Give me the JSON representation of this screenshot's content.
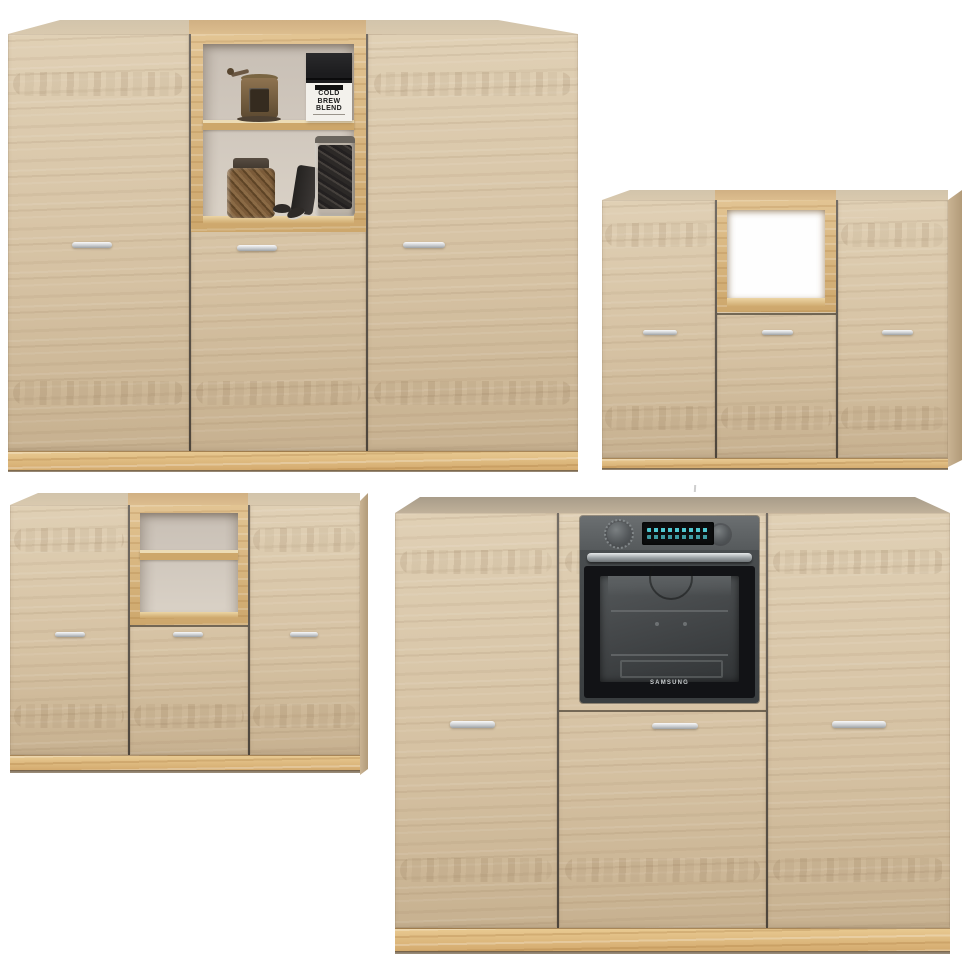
{
  "page": {
    "background": "#ffffff"
  },
  "theme": {
    "colors": {
      "wood_light": "#e0d0b5",
      "wood_base": "#d5c1a2",
      "wood_dark": "#c7b190",
      "plinth_light": "#e8c991",
      "plinth_base": "#d3a96c",
      "gold_light": "#e2c493",
      "gold_base": "#cda76c",
      "cap_light": "#d2c4ab",
      "cap_base": "#d9c9ae",
      "cap_dark_light": "#a89c89",
      "cap_dark_base": "#c0b19a",
      "gap": "#3e352a",
      "niche_back_top": "#c8bfb5",
      "niche_back_bottom": "#dad2c7",
      "handle_light": "#fafafa",
      "handle_mid": "#c7cacd",
      "handle_dark": "#9ea2a5",
      "oven_panel_light": "#6b6f71",
      "oven_panel_dark": "#565a5c",
      "oven_frame": "#4c5052",
      "oven_glass_dark": "#121316",
      "oven_glass_inner": "#46494b",
      "display_bg": "#0c0d0e",
      "display_cyan": "#55d8e2",
      "samsung_text": "#c8ccce",
      "bag_black": "#1c1c1e",
      "bag_label": "#f3f1ec",
      "bag_text": "#1a1a1a"
    }
  },
  "photos": [
    {
      "id": "cabinet-with-styled-shelves",
      "position": "top-left",
      "doors": 3,
      "niche": {
        "shelves": 2,
        "contents": [
          "coffee-grinder",
          "coffee-bag",
          "jar-of-nuts",
          "jar-of-cookies",
          "leaning-lid",
          "cookies"
        ]
      },
      "coffee_bag": {
        "line1": "COLD",
        "line2": "BREW",
        "line3": "BLEND"
      }
    },
    {
      "id": "cabinet-with-open-niche",
      "position": "top-right",
      "doors": 3,
      "niche": {
        "shelves": 0,
        "contents": []
      }
    },
    {
      "id": "cabinet-with-empty-shelves",
      "position": "bottom-left",
      "doors": 3,
      "niche": {
        "shelves": 2,
        "contents": []
      }
    },
    {
      "id": "cabinet-with-built-in-oven",
      "position": "bottom-right",
      "doors": 3,
      "oven": {
        "brand": "SAMSUNG"
      }
    }
  ]
}
